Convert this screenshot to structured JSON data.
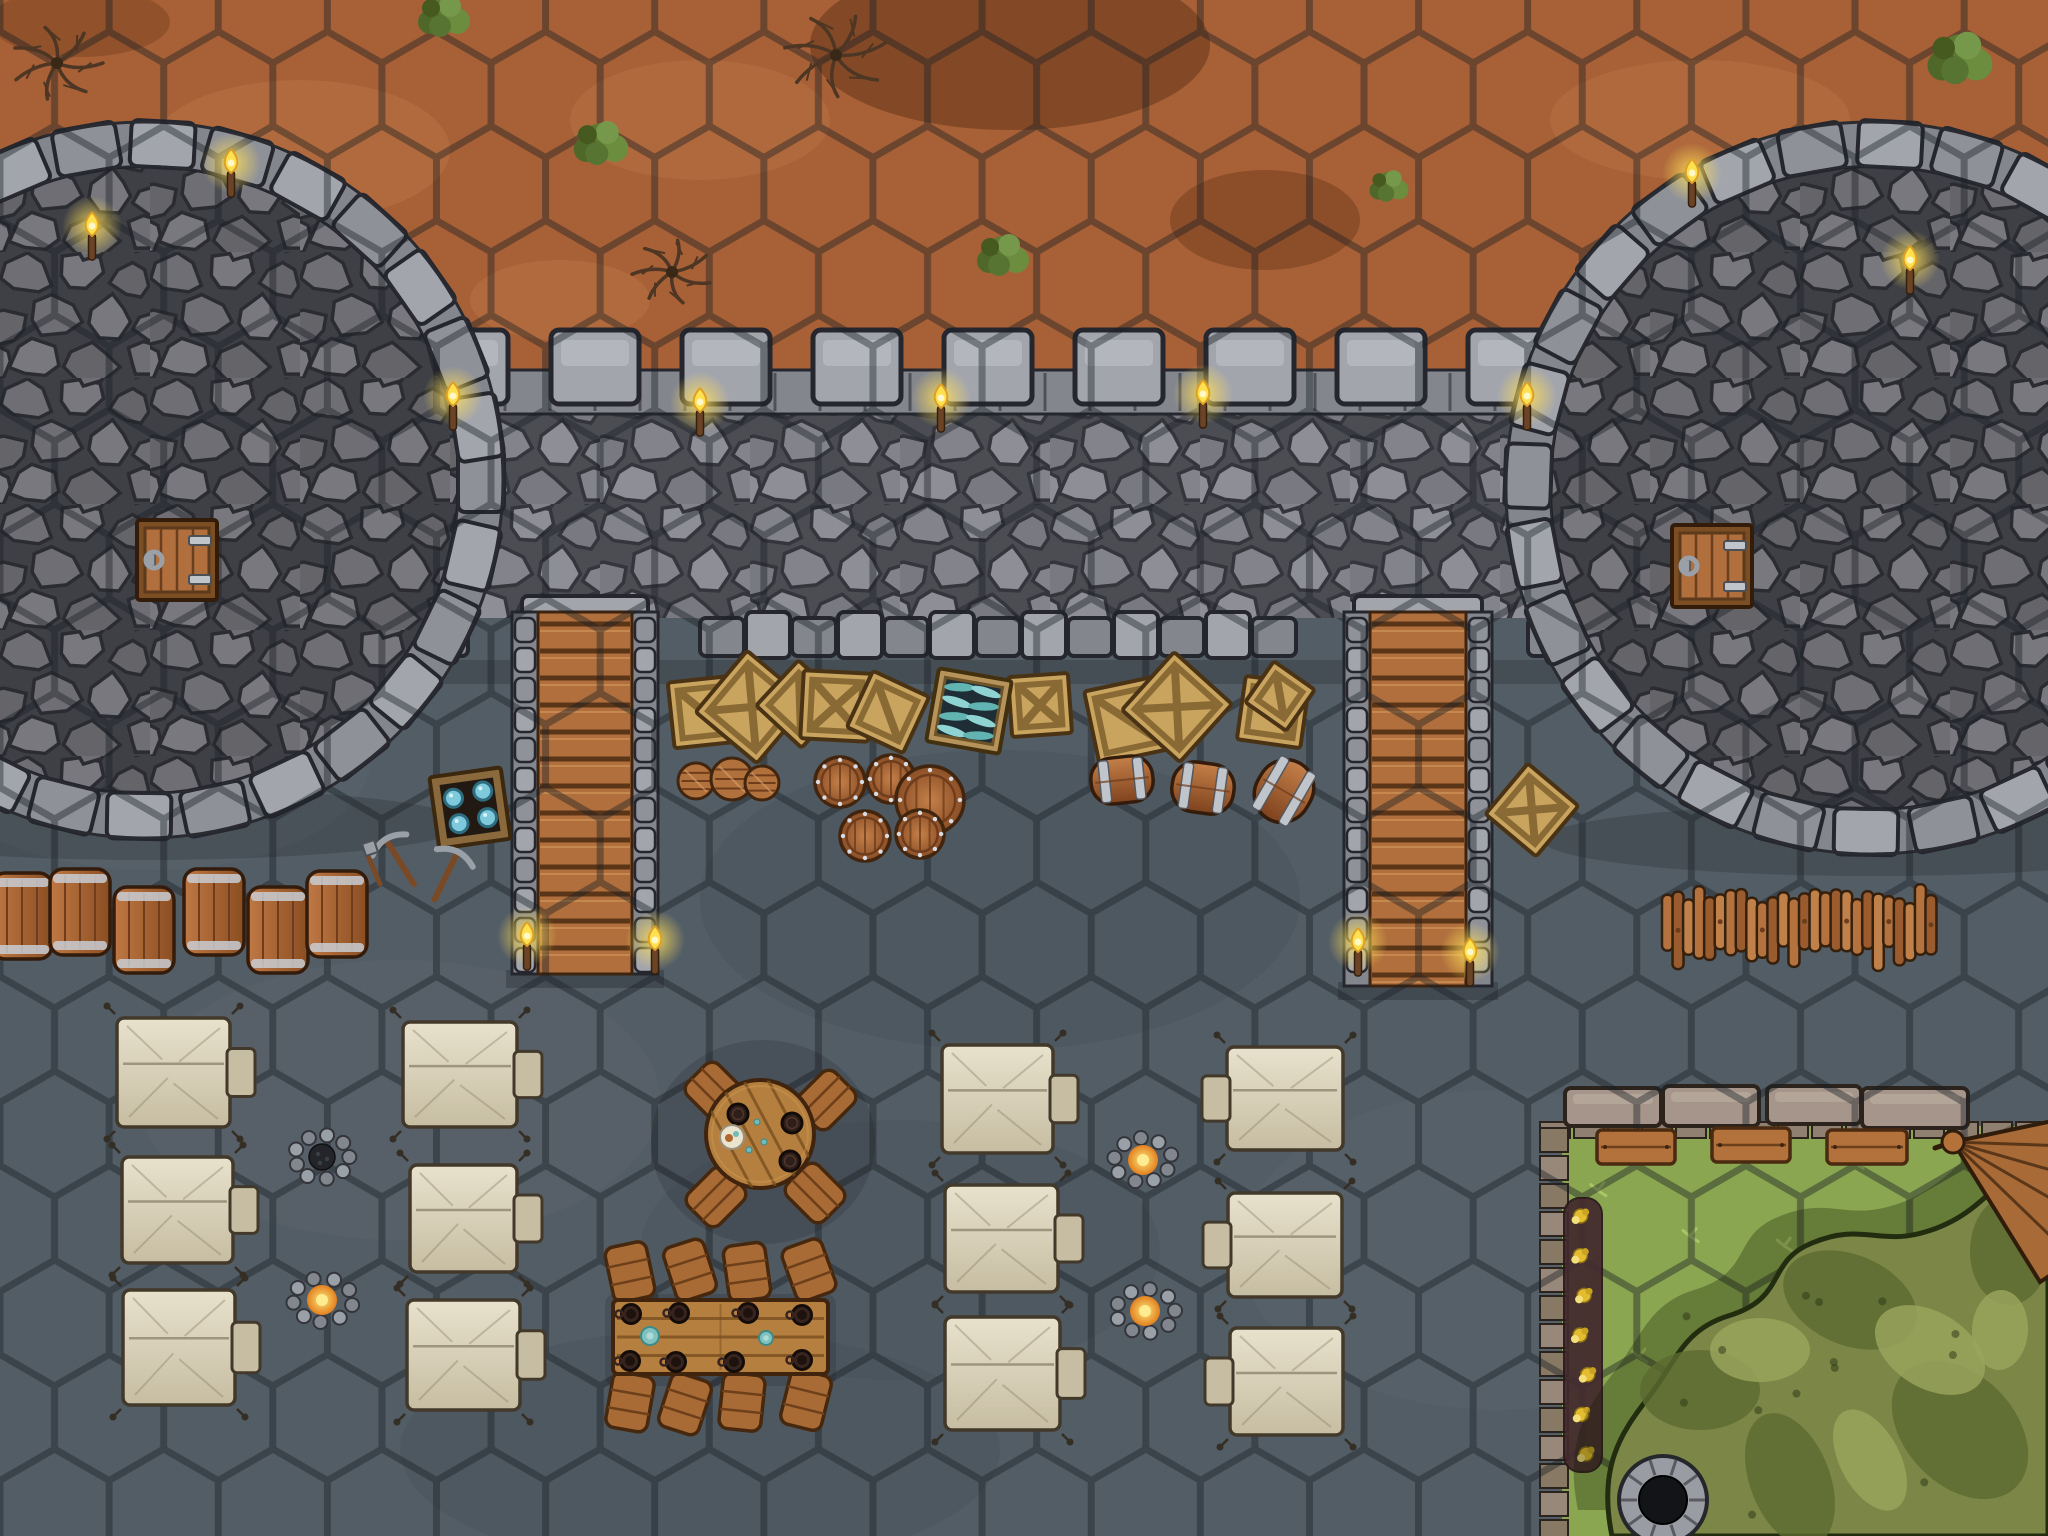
{
  "map": {
    "description": "Top-down hex-grid fantasy battle map: stone curtain wall with two round towers over dirt ground, courtyard encampment with tents, tables, campfires, supplies and a walled garden",
    "width": 2048,
    "height": 1536,
    "hex": {
      "radius": 63,
      "line_color": "#1a1f25",
      "line_width": 7,
      "opacity": 0.42
    },
    "palette": {
      "dirt": "#a86036",
      "dirtLight": "#bd7a49",
      "dirtDark": "#74401f",
      "slate": "#535d66",
      "slateLight": "#626c75",
      "slateDark": "#434c55",
      "grass": "#8aa650",
      "grassLight": "#b4cf6c",
      "stoneLight": "#a3a5ad",
      "stoneMid": "#84868e",
      "stoneDark": "#5a5b61",
      "stoneLine": "#26272e",
      "cobbleGap": "#3a3b41",
      "wood": "#b06f3c",
      "woodDark": "#5b3517",
      "woodLight": "#cf9558",
      "crate": "#c9a45f",
      "crateEdge": "#8a6a34",
      "barrel": "#a9622f",
      "barrelDark": "#6f3d1c",
      "metal": "#c0c4cb",
      "tent": "#ded6bf",
      "tentShade": "#c6bda2",
      "tentLine": "#42392b",
      "flame": "#ffe14f",
      "flameCore": "#fff7c8",
      "ember": "#e2801f",
      "soil": "#43292e",
      "flower": "#e3bd2f",
      "brick": "#a5958a",
      "brickDark": "#8f8072",
      "canopy": "#7b8647",
      "canopyDark": "#5c6a31",
      "canopyLight": "#99a35c",
      "bushGreens": [
        "#5d7a33",
        "#4f682a",
        "#6d8d3e",
        "#587432",
        "#76984a",
        "#46591f"
      ]
    },
    "objects": [
      {
        "type": "rect",
        "name": "dirt-ground",
        "x": 0,
        "y": 0,
        "w": 2048,
        "h": 400,
        "fill": "dirt"
      },
      {
        "type": "blotches",
        "name": "dirt-patches",
        "items": [
          [
            1010,
            45,
            200,
            85,
            "dirtDark",
            0.7
          ],
          [
            1265,
            220,
            95,
            50,
            "dirtDark",
            0.55
          ],
          [
            80,
            22,
            90,
            35,
            "dirtDark",
            0.45
          ],
          [
            300,
            150,
            150,
            70,
            "dirtLight",
            0.4
          ],
          [
            700,
            120,
            130,
            60,
            "dirtLight",
            0.35
          ],
          [
            1700,
            120,
            150,
            60,
            "dirtLight",
            0.35
          ],
          [
            560,
            300,
            90,
            40,
            "dirtLight",
            0.4
          ]
        ]
      },
      {
        "type": "rect",
        "name": "courtyard-ground",
        "x": 0,
        "y": 598,
        "w": 2048,
        "h": 938,
        "fill": "slate"
      },
      {
        "type": "blotches",
        "name": "slate-patches",
        "items": [
          [
            400,
            1100,
            260,
            140,
            "slateLight",
            0.25
          ],
          [
            1000,
            900,
            300,
            150,
            "slateDark",
            0.3
          ],
          [
            1500,
            1250,
            260,
            160,
            "slateLight",
            0.22
          ],
          [
            700,
            1450,
            300,
            120,
            "slateDark",
            0.28
          ],
          [
            150,
            760,
            220,
            110,
            "slateLight",
            0.22
          ],
          [
            900,
            1250,
            260,
            130,
            "slateDark",
            0.2
          ]
        ]
      },
      {
        "type": "rect",
        "name": "garden-ground",
        "x": 1562,
        "y": 1126,
        "w": 486,
        "h": 410,
        "fill": "grass"
      },
      {
        "type": "speckles",
        "name": "grass-sprigs",
        "x": 1575,
        "y": 1150,
        "w": 440,
        "h": 360,
        "count": 24,
        "color": "grassLight"
      },
      {
        "type": "wall",
        "name": "curtain-wall",
        "x": 0,
        "y": 392,
        "w": 2048,
        "h": 226,
        "merlonY": 330,
        "merlonW": 88,
        "merlonH": 74,
        "merlonFrom": 420,
        "merlonTo": 1600,
        "merlonStep": 131,
        "bandX": 280,
        "bandTo": 1608,
        "bandY": 370,
        "bandH": 44,
        "bottomY": 612,
        "bottomFrom": 286,
        "bottomTo": 1604,
        "gaps": [
          [
            504,
            664
          ],
          [
            1336,
            1500
          ]
        ]
      },
      {
        "type": "tower",
        "name": "west-tower",
        "cx": 145,
        "cy": 480,
        "r": 358
      },
      {
        "type": "tower",
        "name": "east-tower",
        "cx": 1872,
        "cy": 488,
        "r": 366
      },
      {
        "type": "stairs",
        "name": "west-stairs",
        "x": 512,
        "y": 612,
        "w": 146,
        "h": 362
      },
      {
        "type": "stairs",
        "name": "east-stairs",
        "x": 1344,
        "y": 612,
        "w": 148,
        "h": 374
      },
      {
        "type": "garden-wall",
        "name": "garden-wall",
        "blocks": [
          [
            1565,
            1088,
            96,
            38
          ],
          [
            1663,
            1086,
            96,
            40
          ],
          [
            1767,
            1086,
            94,
            38
          ],
          [
            1862,
            1088,
            106,
            40
          ]
        ],
        "bandY": 1122,
        "bandFrom": 1540,
        "bandTo": 2040,
        "colX": 1540,
        "colFrom": 1128,
        "colTo": 1530
      },
      {
        "type": "hexgrid",
        "name": "hex-grid"
      },
      {
        "type": "hatch",
        "name": "west-tower-hatch",
        "x": 137,
        "y": 520,
        "w": 80,
        "h": 80
      },
      {
        "type": "hatch",
        "name": "east-tower-hatch",
        "x": 1672,
        "y": 525,
        "w": 80,
        "h": 82
      },
      {
        "type": "torches",
        "name": "torches",
        "items": [
          [
            453,
            398
          ],
          [
            700,
            404
          ],
          [
            941,
            400
          ],
          [
            1203,
            396
          ],
          [
            1527,
            398
          ],
          [
            92,
            228
          ],
          [
            231,
            165
          ],
          [
            1692,
            175
          ],
          [
            1910,
            262
          ],
          [
            527,
            938
          ],
          [
            655,
            942
          ],
          [
            1358,
            944
          ],
          [
            1470,
            954
          ]
        ]
      },
      {
        "type": "crates",
        "name": "supply-crates",
        "items": [
          [
            704,
            712,
            66,
            -6,
            0
          ],
          [
            752,
            707,
            80,
            40,
            1
          ],
          [
            800,
            704,
            62,
            43,
            0
          ],
          [
            836,
            706,
            68,
            3,
            1
          ],
          [
            888,
            712,
            62,
            25,
            0
          ],
          [
            1040,
            705,
            60,
            -4,
            1
          ],
          [
            1128,
            720,
            74,
            -12,
            0
          ],
          [
            1177,
            707,
            78,
            42,
            1
          ],
          [
            1273,
            712,
            64,
            8,
            0
          ],
          [
            1280,
            696,
            50,
            35,
            0
          ],
          [
            1532,
            810,
            66,
            40,
            1
          ]
        ]
      },
      {
        "type": "fish-crate",
        "name": "fish-crate",
        "cx": 969,
        "cy": 711,
        "s": 74,
        "rot": 10
      },
      {
        "type": "gem-crate",
        "name": "open-crate-gems",
        "cx": 470,
        "cy": 808,
        "s": 72,
        "rot": -8
      },
      {
        "type": "tools",
        "name": "pickaxe-tools",
        "cx": 430,
        "cy": 862
      },
      {
        "type": "barrels-top",
        "name": "standing-barrels",
        "items": [
          [
            840,
            782,
            25
          ],
          [
            891,
            779,
            24
          ],
          [
            930,
            800,
            34
          ],
          [
            865,
            836,
            25
          ],
          [
            920,
            834,
            24
          ]
        ]
      },
      {
        "type": "barrels-lid",
        "name": "lidded-barrels",
        "items": [
          [
            696,
            781,
            18
          ],
          [
            732,
            779,
            21
          ],
          [
            762,
            783,
            17
          ]
        ]
      },
      {
        "type": "barrels-side",
        "name": "banded-barrels",
        "items": [
          [
            1122,
            780,
            62,
            46,
            -6
          ],
          [
            1203,
            788,
            62,
            50,
            8
          ],
          [
            1284,
            791,
            56,
            64,
            30
          ]
        ]
      },
      {
        "type": "barrel-row",
        "name": "barrel-row-west",
        "w": 60,
        "h": 86,
        "items": [
          [
            22,
            916
          ],
          [
            80,
            912
          ],
          [
            144,
            930
          ],
          [
            214,
            912
          ],
          [
            278,
            930
          ],
          [
            337,
            914
          ]
        ]
      },
      {
        "type": "log-pile",
        "name": "firewood-pile",
        "x": 1662,
        "y": 884,
        "w": 284,
        "h": 84,
        "count": 26
      },
      {
        "type": "tents",
        "name": "tents",
        "items": [
          [
            117,
            1018,
            113,
            109,
            "r"
          ],
          [
            122,
            1157,
            111,
            106,
            "r"
          ],
          [
            123,
            1290,
            112,
            115,
            "r"
          ],
          [
            403,
            1022,
            114,
            105,
            "r"
          ],
          [
            410,
            1165,
            107,
            107,
            "r"
          ],
          [
            407,
            1300,
            113,
            110,
            "r"
          ],
          [
            942,
            1045,
            111,
            108,
            "r"
          ],
          [
            945,
            1185,
            113,
            107,
            "r"
          ],
          [
            945,
            1317,
            115,
            113,
            "r"
          ],
          [
            1227,
            1047,
            116,
            103,
            "l"
          ],
          [
            1228,
            1193,
            114,
            104,
            "l"
          ],
          [
            1230,
            1328,
            113,
            107,
            "l"
          ]
        ]
      },
      {
        "type": "campfires",
        "name": "campfires",
        "items": [
          [
            322,
            1157,
            0
          ],
          [
            322,
            1300,
            1
          ],
          [
            1143,
            1160,
            1
          ],
          [
            1145,
            1311,
            1
          ]
        ]
      },
      {
        "type": "round-table",
        "name": "round-table",
        "cx": 760,
        "cy": 1134,
        "r": 54,
        "stools": [
          [
            -45,
            -42,
            45
          ],
          [
            66,
            -34,
            -45
          ],
          [
            -44,
            63,
            -45
          ],
          [
            55,
            59,
            45
          ]
        ],
        "darkPlates": [
          [
            -22,
            -20
          ],
          [
            32,
            -11
          ],
          [
            30,
            27
          ]
        ],
        "lightPlate": [
          -28,
          3
        ],
        "scraps": [
          [
            -3,
            -12
          ],
          [
            -11,
            16
          ],
          [
            4,
            8
          ]
        ]
      },
      {
        "type": "long-table",
        "name": "feast-table",
        "x": 613,
        "y": 1300,
        "w": 215,
        "h": 74,
        "stools": [
          [
            630,
            1272,
            -12
          ],
          [
            690,
            1270,
            -18
          ],
          [
            747,
            1272,
            -8
          ],
          [
            809,
            1270,
            -20
          ],
          [
            630,
            1402,
            10
          ],
          [
            685,
            1404,
            18
          ],
          [
            742,
            1402,
            6
          ],
          [
            806,
            1400,
            14
          ]
        ],
        "mugs": [
          [
            631,
            1314
          ],
          [
            679,
            1313
          ],
          [
            748,
            1313
          ],
          [
            802,
            1315
          ],
          [
            630,
            1361
          ],
          [
            676,
            1362
          ],
          [
            734,
            1362
          ],
          [
            802,
            1360
          ]
        ],
        "saucers": [
          [
            650,
            1336,
            9
          ],
          [
            766,
            1338,
            7
          ]
        ]
      },
      {
        "type": "flowerbed",
        "name": "flowerbed",
        "x": 1564,
        "y": 1198,
        "w": 38,
        "h": 274,
        "count": 7
      },
      {
        "type": "benches",
        "name": "garden-benches",
        "items": [
          [
            1597,
            1130,
            78,
            34
          ],
          [
            1712,
            1128,
            78,
            34
          ],
          [
            1827,
            1130,
            80,
            34
          ]
        ]
      },
      {
        "type": "canopy",
        "name": "tree-canopy",
        "path": "M 2048 1150 C 2000 1170 1985 1215 1925 1232 C 1878 1246 1862 1222 1812 1243 C 1765 1262 1788 1298 1728 1316 C 1683 1330 1676 1362 1648 1398 C 1620 1434 1598 1468 1612 1536 L 2048 1536 Z",
        "dark": [
          [
            1700,
            1390,
            60,
            40
          ],
          [
            1850,
            1300,
            70,
            45
          ],
          [
            1960,
            1430,
            80,
            55
          ],
          [
            1790,
            1480,
            70,
            40
          ],
          [
            2010,
            1250,
            55,
            40
          ]
        ],
        "light": [
          [
            1760,
            1350,
            50,
            32
          ],
          [
            1930,
            1350,
            60,
            38
          ],
          [
            1870,
            1460,
            55,
            30
          ],
          [
            2000,
            1330,
            40,
            28
          ]
        ]
      },
      {
        "type": "well",
        "name": "stone-well",
        "cx": 1663,
        "cy": 1500,
        "r": 44
      },
      {
        "type": "umbrella",
        "name": "folded-wooden-umbrella",
        "ax": 1953,
        "ay": 1142
      },
      {
        "type": "dead-trees",
        "name": "dead-trees",
        "items": [
          [
            57,
            63,
            46
          ],
          [
            836,
            55,
            52
          ],
          [
            672,
            272,
            40
          ]
        ]
      },
      {
        "type": "bushes",
        "name": "bushes",
        "items": [
          [
            444,
            16,
            1.0
          ],
          [
            601,
            143,
            1.05
          ],
          [
            1003,
            255,
            1.0
          ],
          [
            1389,
            186,
            0.75
          ],
          [
            1960,
            58,
            1.25
          ]
        ]
      }
    ]
  }
}
